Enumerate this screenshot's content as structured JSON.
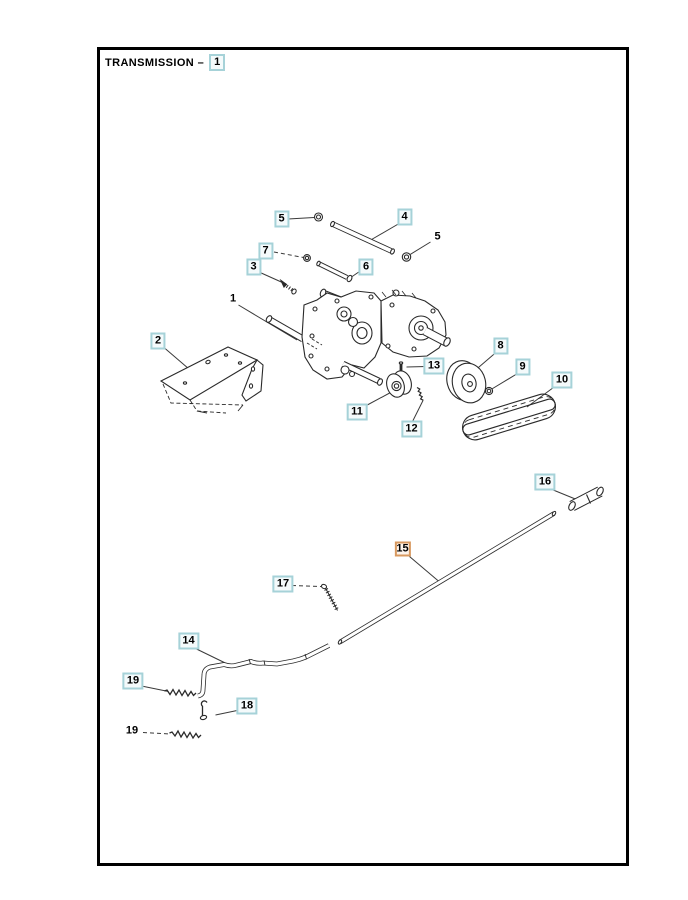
{
  "page": {
    "title": "TRANSMISSION –",
    "title_number": "1"
  },
  "colors": {
    "line": "#2a2a2a",
    "leader": "#3a3a3a",
    "callout_border": "#a6d2d8",
    "callout_fill": "#f4fafb",
    "highlight_border": "#d8995f",
    "highlight_fill": "#fdf4ec",
    "page_border": "#000000",
    "background": "#ffffff"
  },
  "callouts": [
    {
      "label": "5",
      "variant": "boxed"
    },
    {
      "label": "4",
      "variant": "boxed"
    },
    {
      "label": "5",
      "variant": "plain"
    },
    {
      "label": "7",
      "variant": "boxed"
    },
    {
      "label": "3",
      "variant": "boxed"
    },
    {
      "label": "6",
      "variant": "boxed"
    },
    {
      "label": "1",
      "variant": "plain"
    },
    {
      "label": "2",
      "variant": "boxed"
    },
    {
      "label": "8",
      "variant": "boxed"
    },
    {
      "label": "13",
      "variant": "boxed"
    },
    {
      "label": "9",
      "variant": "boxed"
    },
    {
      "label": "10",
      "variant": "boxed"
    },
    {
      "label": "11",
      "variant": "boxed"
    },
    {
      "label": "12",
      "variant": "boxed"
    },
    {
      "label": "16",
      "variant": "boxed"
    },
    {
      "label": "15",
      "variant": "highlighted"
    },
    {
      "label": "17",
      "variant": "boxed"
    },
    {
      "label": "14",
      "variant": "boxed"
    },
    {
      "label": "19",
      "variant": "boxed"
    },
    {
      "label": "18",
      "variant": "boxed"
    },
    {
      "label": "19",
      "variant": "plain"
    }
  ]
}
